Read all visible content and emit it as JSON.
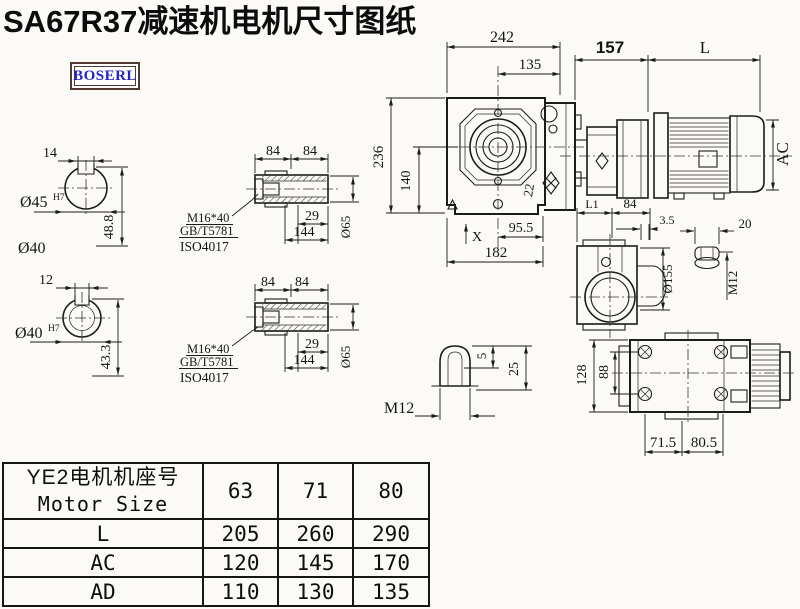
{
  "title": "SA67R37减速机电机尺寸图纸",
  "logo_text": "BOSERL",
  "colors": {
    "line": "#1c1c1c",
    "logo_text": "#2323c8",
    "logo_border": "#503c34",
    "background": "#fbfaf7"
  },
  "views": {
    "solid_shaft_section": {
      "key_width": "14",
      "bore_dia": "Ø45",
      "bore_fit": "H7",
      "key_depth": "48.8",
      "shaft_label": "Ø40"
    },
    "hollow_shaft_section": {
      "key_width": "12",
      "bore_dia": "Ø40",
      "bore_fit": "H7",
      "key_depth": "43.3"
    },
    "hollow_shaft_upper": {
      "len_left": "84",
      "len_right": "84",
      "screw": "M16*40",
      "screw_std_1": "GB/T5781",
      "screw_std_2": "ISO4017",
      "bore_step": "29",
      "total_len": "144",
      "outer_dia": "Ø65"
    },
    "hollow_shaft_lower": {
      "len_left": "84",
      "len_right": "84",
      "screw": "M16*40",
      "screw_std_1": "GB/T5781",
      "screw_std_2": "ISO4017",
      "bore_step": "29",
      "total_len": "144",
      "outer_dia": "Ø65"
    },
    "front_view": {
      "overall_width": "242",
      "center_to_flange": "135",
      "overall_height": "236",
      "center_to_base": "140",
      "bolt_note": "22",
      "foot_to_center": "95.5",
      "base_width": "182",
      "datum": "X"
    },
    "side_view": {
      "gearbox_len": "157",
      "motor_len": "L",
      "motor_od": "AC"
    },
    "flange_view": {
      "dim_l1": "L1",
      "dim_84": "84",
      "lip": "3.5",
      "flange_dia": "Ø155"
    },
    "stud_detail": {
      "length": "20",
      "thread": "M12"
    },
    "plug_detail": {
      "tip": "5",
      "height": "25",
      "thread": "M12"
    },
    "foot_view": {
      "overall": "128",
      "bolt_span": "88",
      "pitch_left": "71.5",
      "pitch_right": "80.5"
    }
  },
  "table": {
    "header_line1": "YE2电机机座号",
    "header_line2": "Motor Size",
    "frame_sizes": [
      "63",
      "71",
      "80"
    ],
    "rows": [
      {
        "label": "L",
        "values": [
          "205",
          "260",
          "290"
        ]
      },
      {
        "label": "AC",
        "values": [
          "120",
          "145",
          "170"
        ]
      },
      {
        "label": "AD",
        "values": [
          "110",
          "130",
          "135"
        ]
      }
    ]
  }
}
